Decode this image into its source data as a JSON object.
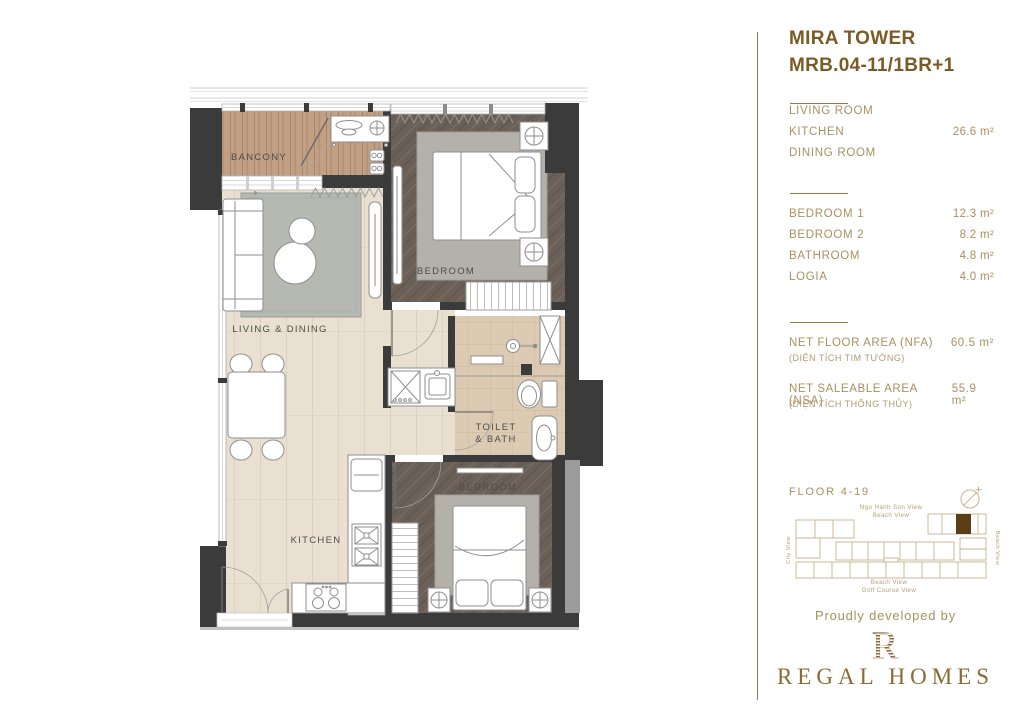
{
  "title": {
    "building": "MIRA TOWER",
    "unit": "MRB.04-11/1BR+1"
  },
  "area_table": {
    "group1": {
      "rows": [
        {
          "label": "LIVING ROOM",
          "value": ""
        },
        {
          "label": "KITCHEN",
          "value": "26.6 m²"
        },
        {
          "label": "DINING ROOM",
          "value": ""
        }
      ]
    },
    "group2": {
      "rows": [
        {
          "label": "BEDROOM 1",
          "value": "12.3 m²"
        },
        {
          "label": "BEDROOM 2",
          "value": "8.2 m²"
        },
        {
          "label": "BATHROOM",
          "value": "4.8 m²"
        },
        {
          "label": "LOGIA",
          "value": "4.0 m²"
        }
      ]
    },
    "summary": [
      {
        "label": "NET FLOOR AREA (NFA)",
        "sublabel": "(DIỆN TÍCH TIM TƯỜNG)",
        "value": "60.5 m²"
      },
      {
        "label": "NET SALEABLE AREA (NSA)",
        "sublabel": "(DIỆN TÍCH THÔNG THỦY)",
        "value": "55.9 m²"
      }
    ]
  },
  "keyplan": {
    "floor_label": "FLOOR 4-19",
    "top_label_line1": "Ngu Hanh Son View",
    "top_label_line2": "Beach View",
    "left_label": "City View",
    "right_label": "Beach View",
    "bottom_label_line1": "Beach View",
    "bottom_label_line2": "Golf Course View"
  },
  "footer": {
    "tagline": "Proudly developed by",
    "brand_name": "REGAL HOMES",
    "logo_letter": "R"
  },
  "plan": {
    "labels": {
      "balcony": "BANCONY",
      "living_dining": "LIVING & DINING",
      "bedroom_top": "BEDROOM",
      "toilet_line1": "TOILET",
      "toilet_line2": "& BATH",
      "bedroom_bottom": "BEDROOM",
      "kitchen": "KITCHEN"
    }
  },
  "colors": {
    "accent_brown": "#7b5b25",
    "gold_text": "#a8905f",
    "divider": "#937949",
    "brand": "#8a6b35",
    "keyplan_unit_fill": "#5b3d16",
    "wall": "#3b3b3b"
  }
}
